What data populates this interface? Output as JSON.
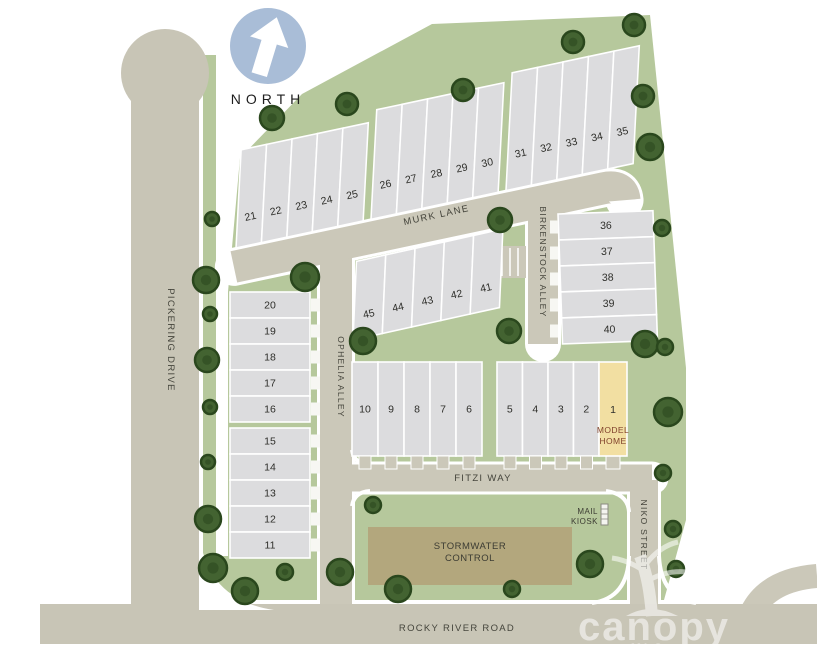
{
  "compass": {
    "label": "NORTH"
  },
  "streets": {
    "murk_lane": "MURK LANE",
    "birkenstock_alley": "BIRKENSTOCK ALLEY",
    "ophelia_alley": "OPHELIA ALLEY",
    "pickering_drive": "PICKERING DRIVE",
    "fitzi_way": "FITZI WAY",
    "niko_street": "NIKO STREET",
    "rocky_river_road": "ROCKY RIVER ROAD"
  },
  "features": {
    "stormwater_line1": "STORMWATER",
    "stormwater_line2": "CONTROL",
    "mail_kiosk_line1": "MAIL",
    "mail_kiosk_line2": "KIOSK",
    "model_home_line1": "MODEL",
    "model_home_line2": "HOME"
  },
  "lots": {
    "row_21_25": [
      "21",
      "22",
      "23",
      "24",
      "25"
    ],
    "row_26_30": [
      "26",
      "27",
      "28",
      "29",
      "30"
    ],
    "row_31_35": [
      "31",
      "32",
      "33",
      "34",
      "35"
    ],
    "col_36_40": [
      "36",
      "37",
      "38",
      "39",
      "40"
    ],
    "row_45_41": [
      "45",
      "44",
      "43",
      "42",
      "41"
    ],
    "col_20_16": [
      "20",
      "19",
      "18",
      "17",
      "16"
    ],
    "col_15_11": [
      "15",
      "14",
      "13",
      "12",
      "11"
    ],
    "row_10_6": [
      "10",
      "9",
      "8",
      "7",
      "6"
    ],
    "row_5_2": [
      "5",
      "4",
      "3",
      "2"
    ],
    "model_home_number": "1"
  },
  "watermark": {
    "brand": "canopy",
    "sub": "MLS"
  },
  "colors": {
    "site_green": "#b6c89c",
    "road": "#cbc8b9",
    "lot_gray": "#dcdcde",
    "model_home_yellow": "#f2dfa2",
    "stormwater_khaki": "#b3a77d",
    "north_badge_blue": "#a9bdd7",
    "tree_green": "#436331"
  }
}
